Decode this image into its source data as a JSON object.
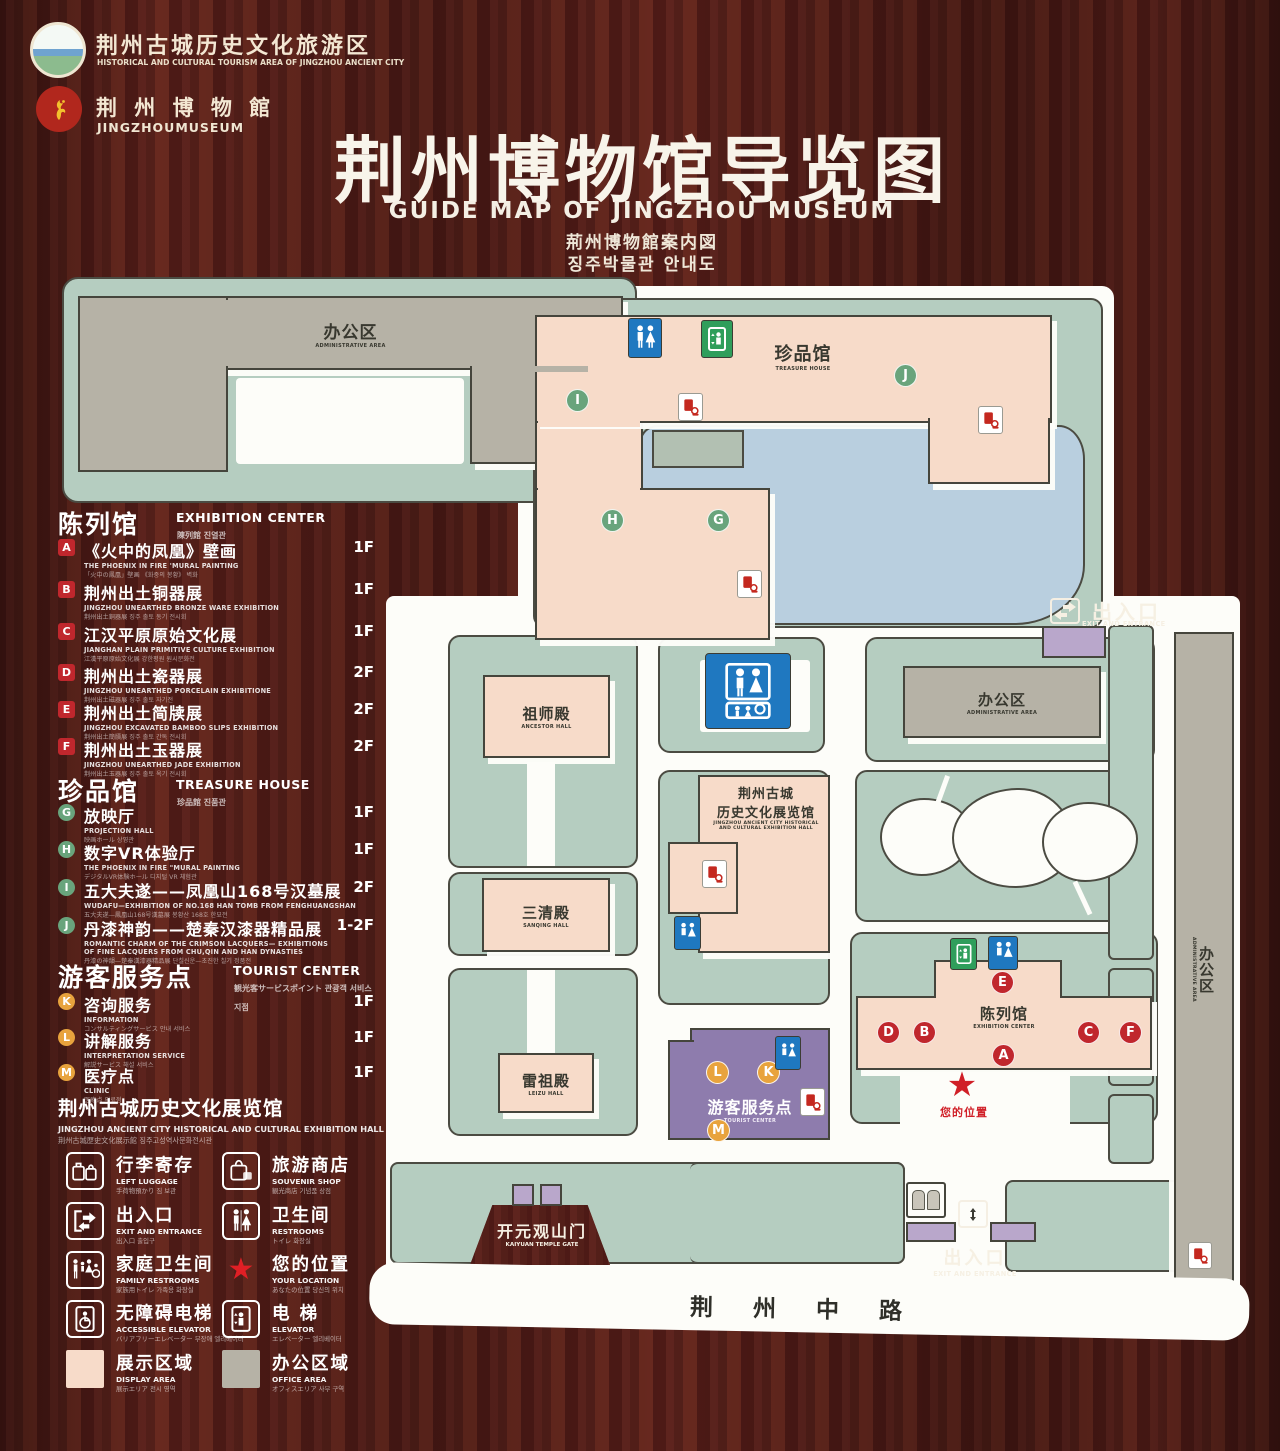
{
  "header": {
    "logo1": {
      "zh": "荆州古城历史文化旅游区",
      "en": "HISTORICAL AND CULTURAL TOURISM AREA OF JINGZHOU ANCIENT CITY"
    },
    "logo2": {
      "zh": "荆 州 博 物 館",
      "en": "JINGZHOUMUSEUM"
    },
    "title_zh": "荆州博物馆导览图",
    "title_en": "GUIDE MAP OF JINGZHOU MUSEUM",
    "title_jp": "荊州博物館案内図",
    "title_kr": "징주박물관 안내도"
  },
  "sidebar": {
    "exhibition": {
      "zh": "陈列馆",
      "en": "EXHIBITION CENTER",
      "sub": "陳列館  진열관",
      "items": [
        {
          "letter": "A",
          "zh": "《火中的凤凰》壁画",
          "en": "THE PHOENIX IN FIRE 'MURAL PAINTING",
          "sub": "「火中の鳳凰」壁画 《화중의 봉황》 벽화",
          "floor": "1F"
        },
        {
          "letter": "B",
          "zh": "荆州出土铜器展",
          "en": "JINGZHOU UNEARTHED BRONZE WARE EXHIBITION",
          "sub": "荆州出土銅器展  징주 출토 동기 전시회",
          "floor": "1F"
        },
        {
          "letter": "C",
          "zh": "江汉平原原始文化展",
          "en": "JIANGHAN PLAIN PRIMITIVE CULTURE EXHIBITION",
          "sub": "江漢平原原始文化展  강한평원 원시문화전",
          "floor": "1F"
        },
        {
          "letter": "D",
          "zh": "荆州出土瓷器展",
          "en": "JINGZHOU UNEARTHED PORCELAIN EXHIBITIONE",
          "sub": "荆州出土磁器展  징주 출토 자기전",
          "floor": "2F"
        },
        {
          "letter": "E",
          "zh": "荆州出土简牍展",
          "en": "JINGZHOU EXCAVATED BAMBOO SLIPS EXHIBITION",
          "sub": "荆州出土簡牘展  징주 출토 간독 전시회",
          "floor": "2F"
        },
        {
          "letter": "F",
          "zh": "荆州出土玉器展",
          "en": "JINGZHOU UNEARTHED JADE EXHIBITION",
          "sub": "荆州出土玉器展  징주 출토 옥기 전시회",
          "floor": "2F"
        }
      ]
    },
    "treasure": {
      "zh": "珍品馆",
      "en": "TREASURE HOUSE",
      "sub": "珍品館  진품관",
      "items": [
        {
          "letter": "G",
          "zh": "放映厅",
          "en": "PROJECTION HALL",
          "sub": "映画ホール  상영관",
          "floor": "1F"
        },
        {
          "letter": "H",
          "zh": "数字VR体验厅",
          "en": "THE PHOENIX IN FIRE \"MURAL PAINTING",
          "sub": "デジタルVR体験ホール  디지털 VR 체험관",
          "floor": "1F"
        },
        {
          "letter": "I",
          "zh": "五大夫遂——凤凰山168号汉墓展",
          "en": "WUDAFU—EXHIBITION OF NO.168 HAN TOMB FROM FENGHUANGSHAN",
          "sub": "五大夫遂—鳳凰山168号漢墓展  봉황산 168호 한묘전",
          "floor": "2F"
        },
        {
          "letter": "J",
          "zh": "丹漆神韵——楚秦汉漆器精品展",
          "en": "ROMANTIC CHARM OF THE CRIMSON LACQUERS— EXHIBITIONS",
          "en2": "OF FINE LACQUERS FROM CHU,QIN AND HAN DYNASTIES",
          "sub": "丹漆の神韻—楚秦漢漆器精品展  단칠신운—초진한 칠기 정품전",
          "floor": "1-2F"
        }
      ]
    },
    "tourist": {
      "zh": "游客服务点",
      "en": "TOURIST CENTER",
      "sub": "観光客サービスポイント  관광객 서비스 지점",
      "items": [
        {
          "letter": "K",
          "zh": "咨询服务",
          "en": "INFORMATION",
          "sub": "コンサルティングサービス  안내 서비스",
          "floor": "1F"
        },
        {
          "letter": "L",
          "zh": "讲解服务",
          "en": "INTERPRETATION SERVICE",
          "sub": "解説サービス  해설 서비스",
          "floor": "1F"
        },
        {
          "letter": "M",
          "zh": "医疗点",
          "en": "CLINIC",
          "sub": "医療点  의료점",
          "floor": "1F"
        }
      ]
    },
    "hall_note": {
      "zh": "荆州古城历史文化展览馆",
      "en": "JINGZHOU ANCIENT CITY HISTORICAL AND CULTURAL EXHIBITION HALL",
      "sub": "荆州古城歴史文化展示館    징주고성역사문화전시관"
    },
    "legend": [
      {
        "zh": "行李寄存",
        "en": "LEFT LUGGAGE",
        "sub": "手荷物預かり  짐 보관"
      },
      {
        "zh": "旅游商店",
        "en": "SOUVENIR SHOP",
        "sub": "観光商店  기념품 상점"
      },
      {
        "zh": "出入口",
        "en": "EXIT AND ENTRANCE",
        "sub": "出入口  출입구"
      },
      {
        "zh": "卫生间",
        "en": "RESTROOMS",
        "sub": "トイレ  화장실"
      },
      {
        "zh": "家庭卫生间",
        "en": "FAMILY RESTROOMS",
        "sub": "家族用トイレ  가족용 화장실"
      },
      {
        "zh": "您的位置",
        "en": "YOUR LOCATION",
        "sub": "あなたの位置  당신의 위치"
      },
      {
        "zh": "无障碍电梯",
        "en": "ACCESSIBLE ELEVATOR",
        "sub": "バリアフリーエレベーター  무장애 엘리베이터"
      },
      {
        "zh": "电  梯",
        "en": "ELEVATOR",
        "sub": "エレベーター  엘리베이터"
      },
      {
        "zh": "展示区域",
        "en": "DISPLAY AREA",
        "sub": "展示エリア  전시 영역"
      },
      {
        "zh": "办公区域",
        "en": "OFFICE AREA",
        "sub": "オフィスエリア  사무 구역"
      }
    ]
  },
  "map": {
    "admin_area": {
      "zh": "办公区",
      "en": "ADMINISTRATIVE AREA"
    },
    "treasure_house": {
      "zh": "珍品馆",
      "en": "TREASURE HOUSE"
    },
    "ancestor_hall": {
      "zh": "祖师殿",
      "en": "ANCESTOR HALL"
    },
    "sanqing_hall": {
      "zh": "三清殿",
      "en": "SANQING HALL"
    },
    "leizu_hall": {
      "zh": "雷祖殿",
      "en": "LEIZU HALL"
    },
    "exhibition_hall": {
      "zh1": "荆州古城",
      "zh2": "历史文化展览馆",
      "en1": "JINGZHOU ANCIENT CITY HISTORICAL",
      "en2": "AND CULTURAL EXHIBITION HALL"
    },
    "exhibition_center": {
      "zh": "陈列馆",
      "en": "EXHIBITION CENTER"
    },
    "tourist_center": {
      "zh": "游客服务点",
      "en": "TOURIST CENTER"
    },
    "exit": {
      "zh": "出入口",
      "en": "EXIT AND ENTRANCE"
    },
    "kaiyuan_gate": {
      "zh": "开元观山门",
      "en": "KAIYUAN TEMPLE GATE"
    },
    "road": {
      "zh": "荆 州 中 路"
    },
    "your_location": {
      "zh": "您的位置"
    },
    "markers": {
      "A": "A",
      "B": "B",
      "C": "C",
      "D": "D",
      "E": "E",
      "F": "F",
      "G": "G",
      "H": "H",
      "I": "I",
      "J": "J",
      "K": "K",
      "L": "L",
      "M": "M"
    }
  },
  "colors": {
    "display_area": "#f7dbc9",
    "office_area": "#b6b2a6",
    "parcel_green": "#b5cdc0",
    "pond_blue": "#b9cfdf",
    "accent_red": "#c0272d",
    "marker_green": "#69a47c",
    "marker_orange": "#e8a33d",
    "restroom_blue": "#1f78c0",
    "elevator_green": "#2f9e5b",
    "tourist_purple": "#8e7cad",
    "your_location_red": "#d01f27",
    "wood_bg": "#58211c"
  }
}
